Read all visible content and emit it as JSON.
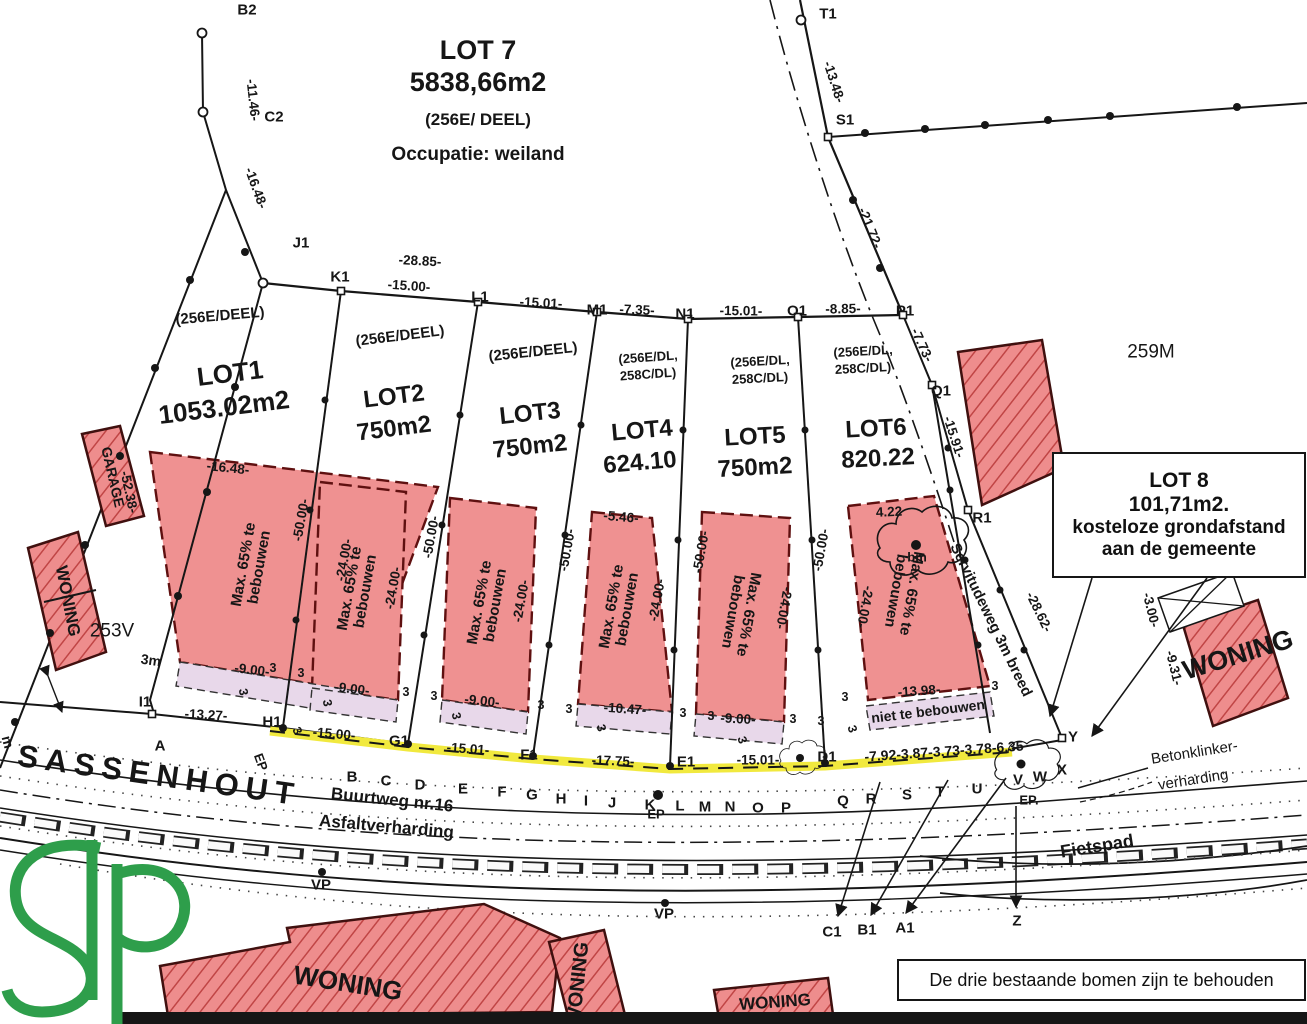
{
  "colors": {
    "zone_fill": "#ef9191",
    "hatch_fill": "#ee8d8d",
    "hatch_line": "#c04545",
    "strip_lavender": "#e8d8ea",
    "road_marking_yellow": "#f1e93e",
    "logo_green": "#2e9e4b",
    "ink": "#161616"
  },
  "lot7": {
    "title": "LOT 7",
    "area": "5838,66m2",
    "parcel": "(256E/ DEEL)",
    "occupation": "Occupatie: weiland"
  },
  "lot8": {
    "l1": "LOT 8",
    "l2": "101,71m2.",
    "l3": "kosteloze grondafstand",
    "l4": "aan de gemeente"
  },
  "notes": {
    "trees": "De drie bestaande bomen zijn te behouden",
    "no_build": "niet te bebouwen"
  },
  "areas": {
    "right": "259M",
    "left": "253V"
  },
  "street": {
    "name": "SASSENHOUT",
    "road": "Buurtweg nr.16",
    "surface": "Asfaltverharding",
    "bike": "Fietspad",
    "paving1": "Betonklinker-",
    "paving2": "verharding",
    "servitude": "Servitudeweg 3m breed"
  },
  "lots": [
    {
      "name": "LOT1",
      "area": "1053.02m2",
      "p1": "(256E/DEEL)",
      "p2": "",
      "zone": "Max. 65% te bebouwen"
    },
    {
      "name": "LOT2",
      "area": "750m2",
      "p1": "(256E/DEEL)",
      "p2": "",
      "zone": "Max. 65% te bebouwen"
    },
    {
      "name": "LOT3",
      "area": "750m2",
      "p1": "(256E/DEEL)",
      "p2": "",
      "zone": "Max. 65% te bebouwen"
    },
    {
      "name": "LOT4",
      "area": "624.10",
      "p1": "(256E/DL,",
      "p2": "258C/DL)",
      "zone": "Max. 65% te bebouwen"
    },
    {
      "name": "LOT5",
      "area": "750m2",
      "p1": "(256E/DL,",
      "p2": "258C/DL)",
      "zone": "Max. 65% te bebouwen"
    },
    {
      "name": "LOT6",
      "area": "820.22",
      "p1": "(256E/DL,",
      "p2": "258C/DL)",
      "zone": "Max. 65% te bebouwen"
    }
  ],
  "points": [
    {
      "id": "B2",
      "x": 247,
      "y": 10
    },
    {
      "id": "C2",
      "x": 274,
      "y": 117
    },
    {
      "id": "J1",
      "x": 301,
      "y": 243
    },
    {
      "id": "K1",
      "x": 340,
      "y": 277
    },
    {
      "id": "L1",
      "x": 480,
      "y": 297
    },
    {
      "id": "M1",
      "x": 597,
      "y": 310
    },
    {
      "id": "N1",
      "x": 685,
      "y": 314
    },
    {
      "id": "O1",
      "x": 797,
      "y": 311
    },
    {
      "id": "P1",
      "x": 905,
      "y": 311
    },
    {
      "id": "Q1",
      "x": 941,
      "y": 391
    },
    {
      "id": "R1",
      "x": 982,
      "y": 518
    },
    {
      "id": "S1",
      "x": 845,
      "y": 120
    },
    {
      "id": "T1",
      "x": 828,
      "y": 14
    },
    {
      "id": "I1",
      "x": 145,
      "y": 702
    },
    {
      "id": "H1",
      "x": 272,
      "y": 722
    },
    {
      "id": "G1",
      "x": 399,
      "y": 741
    },
    {
      "id": "F1",
      "x": 529,
      "y": 755
    },
    {
      "id": "E1",
      "x": 686,
      "y": 762
    },
    {
      "id": "D1",
      "x": 827,
      "y": 757
    },
    {
      "id": "Y",
      "x": 1073,
      "y": 737
    },
    {
      "id": "Z",
      "x": 1017,
      "y": 921
    },
    {
      "id": "A1",
      "x": 905,
      "y": 928
    },
    {
      "id": "B1",
      "x": 867,
      "y": 930
    },
    {
      "id": "C1",
      "x": 832,
      "y": 932
    }
  ],
  "road_letters": [
    {
      "t": "A",
      "x": 160,
      "y": 746
    },
    {
      "t": "B",
      "x": 352,
      "y": 777
    },
    {
      "t": "C",
      "x": 386,
      "y": 781
    },
    {
      "t": "D",
      "x": 420,
      "y": 785
    },
    {
      "t": "E",
      "x": 463,
      "y": 789
    },
    {
      "t": "F",
      "x": 502,
      "y": 792
    },
    {
      "t": "G",
      "x": 532,
      "y": 795
    },
    {
      "t": "H",
      "x": 561,
      "y": 799
    },
    {
      "t": "I",
      "x": 586,
      "y": 801
    },
    {
      "t": "J",
      "x": 612,
      "y": 803
    },
    {
      "t": "K",
      "x": 650,
      "y": 805
    },
    {
      "t": "L",
      "x": 680,
      "y": 806
    },
    {
      "t": "M",
      "x": 705,
      "y": 807
    },
    {
      "t": "N",
      "x": 730,
      "y": 807
    },
    {
      "t": "O",
      "x": 758,
      "y": 808
    },
    {
      "t": "P",
      "x": 786,
      "y": 808
    },
    {
      "t": "Q",
      "x": 843,
      "y": 801
    },
    {
      "t": "R",
      "x": 871,
      "y": 799
    },
    {
      "t": "S",
      "x": 907,
      "y": 795
    },
    {
      "t": "T",
      "x": 940,
      "y": 792
    },
    {
      "t": "U",
      "x": 977,
      "y": 789
    },
    {
      "t": "V",
      "x": 1018,
      "y": 780
    },
    {
      "t": "W",
      "x": 1040,
      "y": 777
    },
    {
      "t": "X",
      "x": 1062,
      "y": 770
    }
  ],
  "dims": [
    {
      "t": "-11.46-",
      "x": 253,
      "y": 100,
      "r": 84
    },
    {
      "t": "-16.48-",
      "x": 256,
      "y": 188,
      "r": 70
    },
    {
      "t": "-28.85-",
      "x": 420,
      "y": 261,
      "r": 3
    },
    {
      "t": "-15.00-",
      "x": 409,
      "y": 286,
      "r": 4
    },
    {
      "t": "-15.01-",
      "x": 541,
      "y": 303,
      "r": 3
    },
    {
      "t": "-7.35-",
      "x": 637,
      "y": 310,
      "r": 2
    },
    {
      "t": "-15.01-",
      "x": 741,
      "y": 311,
      "r": 1
    },
    {
      "t": "-8.85-",
      "x": 843,
      "y": 309,
      "r": -1
    },
    {
      "t": "-7.73-",
      "x": 922,
      "y": 345,
      "r": 65
    },
    {
      "t": "-13.48-",
      "x": 834,
      "y": 82,
      "r": 72
    },
    {
      "t": "-21.72-",
      "x": 870,
      "y": 228,
      "r": 68
    },
    {
      "t": "-15.91-",
      "x": 954,
      "y": 437,
      "r": 72
    },
    {
      "t": "-28.62-",
      "x": 1039,
      "y": 612,
      "r": 64
    },
    {
      "t": "-52.38-",
      "x": 129,
      "y": 492,
      "r": 78
    },
    {
      "t": "-3.00-",
      "x": 1151,
      "y": 610,
      "r": 76
    },
    {
      "t": "-9.31-",
      "x": 1174,
      "y": 668,
      "r": 76
    },
    {
      "t": "-50.00-",
      "x": 301,
      "y": 520,
      "r": -80
    },
    {
      "t": "-50.00-",
      "x": 431,
      "y": 537,
      "r": -80
    },
    {
      "t": "-50.00-",
      "x": 567,
      "y": 550,
      "r": -80
    },
    {
      "t": "-50.00-",
      "x": 701,
      "y": 552,
      "r": -80
    },
    {
      "t": "-50.00-",
      "x": 821,
      "y": 550,
      "r": -80
    },
    {
      "t": "-16.48-",
      "x": 228,
      "y": 468,
      "r": 6
    },
    {
      "t": "-5.46-",
      "x": 621,
      "y": 517,
      "r": 5
    },
    {
      "t": "4.22",
      "x": 889,
      "y": 512,
      "r": -3
    },
    {
      "t": "-24.00-",
      "x": 344,
      "y": 560,
      "r": -80
    },
    {
      "t": "-24.00-",
      "x": 393,
      "y": 588,
      "r": -80
    },
    {
      "t": "-24.00-",
      "x": 521,
      "y": 601,
      "r": -80
    },
    {
      "t": "-24.00-",
      "x": 657,
      "y": 600,
      "r": -80
    },
    {
      "t": "-24.00-",
      "x": 784,
      "y": 608,
      "r": 100
    },
    {
      "t": "-24.00-",
      "x": 865,
      "y": 607,
      "r": 100
    },
    {
      "t": "-9.00-",
      "x": 252,
      "y": 670,
      "r": 7
    },
    {
      "t": "-9.00-",
      "x": 352,
      "y": 689,
      "r": 7
    },
    {
      "t": "-9.00-",
      "x": 482,
      "y": 701,
      "r": 6
    },
    {
      "t": "-10.47-",
      "x": 625,
      "y": 709,
      "r": 4
    },
    {
      "t": "-9.00-",
      "x": 738,
      "y": 719,
      "r": 3
    },
    {
      "t": "-13.98-",
      "x": 919,
      "y": 691,
      "r": -4
    },
    {
      "t": "-13.27-",
      "x": 206,
      "y": 715,
      "r": 3
    },
    {
      "t": "-15.00-",
      "x": 334,
      "y": 734,
      "r": 5
    },
    {
      "t": "-15.01-",
      "x": 468,
      "y": 749,
      "r": 4
    },
    {
      "t": "-17.75-",
      "x": 613,
      "y": 761,
      "r": 2
    },
    {
      "t": "-15.01-",
      "x": 758,
      "y": 760,
      "r": 0
    },
    {
      "t": "-7.92-3.87-3.73-3.78-6.35",
      "x": 944,
      "y": 751,
      "r": -4,
      "fs": 14
    }
  ],
  "smalls": [
    {
      "t": "3m",
      "x": 151,
      "y": 660,
      "r": 8,
      "fs": 14
    },
    {
      "t": "m",
      "x": 8,
      "y": 742,
      "r": 75,
      "fs": 14
    },
    {
      "t": "bm",
      "x": 917,
      "y": 557,
      "fs": 13
    },
    {
      "t": "VP",
      "x": 321,
      "y": 885,
      "fs": 15
    },
    {
      "t": "VP",
      "x": 664,
      "y": 914,
      "fs": 15
    },
    {
      "t": "EP",
      "x": 261,
      "y": 762,
      "r": 70,
      "fs": 13
    },
    {
      "t": "EP",
      "x": 656,
      "y": 814,
      "fs": 13
    },
    {
      "t": "EP.",
      "x": 1029,
      "y": 800,
      "fs": 13
    },
    {
      "t": "3",
      "x": 273,
      "y": 668
    },
    {
      "t": "3",
      "x": 301,
      "y": 673
    },
    {
      "t": "3",
      "x": 406,
      "y": 692
    },
    {
      "t": "3",
      "x": 434,
      "y": 696
    },
    {
      "t": "3",
      "x": 541,
      "y": 705
    },
    {
      "t": "3",
      "x": 569,
      "y": 709
    },
    {
      "t": "3",
      "x": 683,
      "y": 713
    },
    {
      "t": "3",
      "x": 711,
      "y": 716
    },
    {
      "t": "3",
      "x": 793,
      "y": 719
    },
    {
      "t": "3",
      "x": 821,
      "y": 721
    },
    {
      "t": "3",
      "x": 845,
      "y": 697
    },
    {
      "t": "3",
      "x": 995,
      "y": 686
    },
    {
      "t": "3",
      "x": 243,
      "y": 692,
      "r": 80
    },
    {
      "t": "3",
      "x": 327,
      "y": 703,
      "r": 80
    },
    {
      "t": "3",
      "x": 456,
      "y": 716,
      "r": 78
    },
    {
      "t": "3",
      "x": 601,
      "y": 728,
      "r": 76
    },
    {
      "t": "3",
      "x": 742,
      "y": 740,
      "r": 74
    },
    {
      "t": "3",
      "x": 852,
      "y": 729,
      "r": 72
    },
    {
      "t": "3",
      "x": 297,
      "y": 731,
      "r": 65
    }
  ],
  "building_labels": [
    {
      "t": "GARAGE",
      "x": 113,
      "y": 477,
      "r": 77,
      "fs": 14
    },
    {
      "t": "WONING",
      "x": 68,
      "y": 601,
      "r": 79,
      "fs": 17
    },
    {
      "t": "WONING",
      "x": 1238,
      "y": 655,
      "r": -17,
      "fs": 27
    },
    {
      "t": "WONING",
      "x": 348,
      "y": 983,
      "r": 9,
      "fs": 26
    },
    {
      "t": "WONING",
      "x": 578,
      "y": 984,
      "r": -84,
      "fs": 20
    },
    {
      "t": "WONING",
      "x": 775,
      "y": 1002,
      "r": -4,
      "fs": 17
    }
  ]
}
